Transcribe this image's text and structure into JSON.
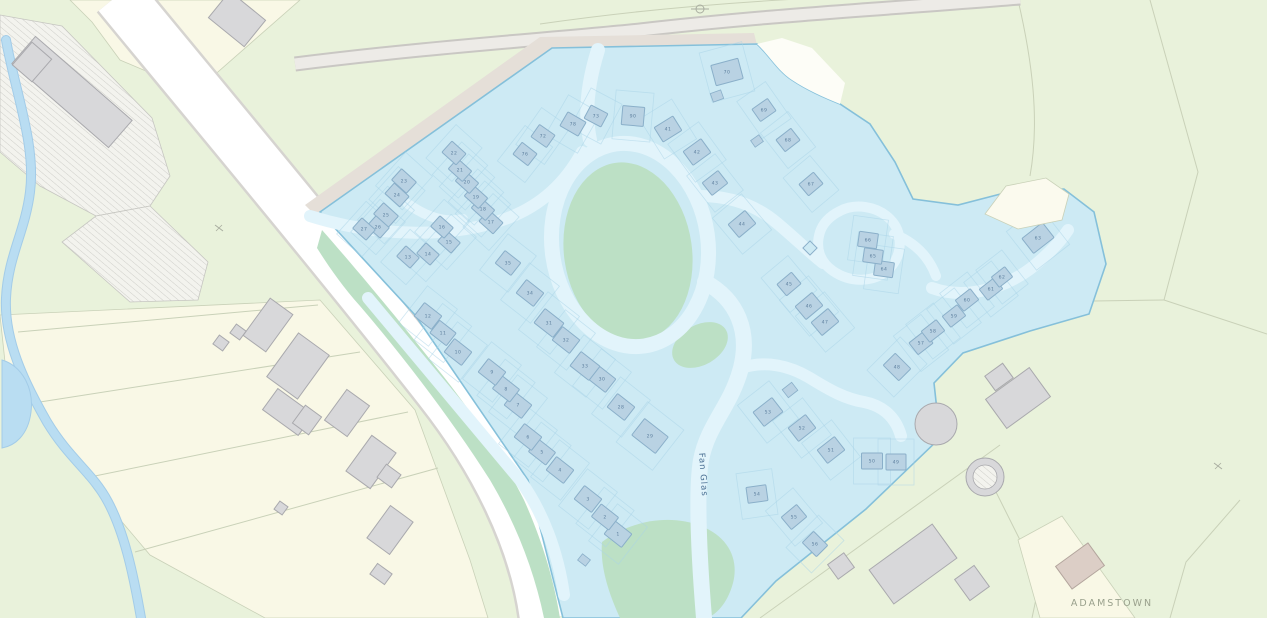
{
  "labels": {
    "street": "Fan Glas",
    "townland": "ADAMSTOWN",
    "street_x": 699,
    "street_y": 453,
    "street_rot": 86,
    "townland_x": 1112,
    "townland_y": 606
  },
  "colors": {
    "field_green": "#e9f2db",
    "cream_field": "#f9f8e6",
    "field_line": "#c9d1b8",
    "hatch_line": "#c6c6c1",
    "stream": "#b9ddf2",
    "stream_edge": "#a3cce8",
    "road_main": "#ffffff",
    "road_main_edge": "#d6d4d0",
    "road_top": "#edebe7",
    "road_top_edge": "#c9c7c3",
    "verge": "#e5dfd8",
    "estate_fill": "#cdeaf4",
    "estate_edge": "#85c0da",
    "estate_green": "#bce0c5",
    "road_inner": "#e2f4fb",
    "lot_line": "#a9d4e7",
    "bldg_fill": "#b9d2e3",
    "bldg_edge": "#8aafc9",
    "grey_fill": "#d8d8da",
    "grey_edge": "#a9a9ad",
    "tan_fill": "#dccec6",
    "tan_edge": "#b3a59d",
    "notch": "#fdfdf7",
    "tan_parcel": "#fbfaee",
    "num_color": "#5d7f9e",
    "street_label": "#4a6f93",
    "townland_label": "#9aa18d",
    "symbol_grey": "#a9ada0"
  },
  "terrain": {
    "cream_fields": [
      "M70,0 L300,0 L195,92 L120,60 L92,22 Z",
      "M0,315 L320,300 L415,410 L470,560 L488,618 L265,618 L150,555 L95,490 L40,412 L5,362 Z"
    ],
    "field_lines": [
      "M318,305 L18,332",
      "M360,352 L40,402",
      "M408,412 L85,478",
      "M438,468 L135,552",
      "M1150,0 L1198,172 L1164,300",
      "M1164,300 L1094,301",
      "M1164,300 L1267,334",
      "M1018,0 C1032,60 1040,120 1030,176",
      "M540,24 C650,8 760,0 860,-4",
      "M760,618 L1000,445",
      "M985,470 L1040,580 L1032,618",
      "M1240,500 L1186,562 L1170,618",
      "M195,92 L250,120"
    ],
    "hatch_areas": [
      "M0,15 L62,26 L152,118 L170,176 L150,206 L96,216 L40,186 L0,152 Z",
      "M96,216 L150,206 L208,262 L198,300 L130,302 L62,242 Z"
    ],
    "white_notch": "M757,44 C770,56 777,70 792,80 C807,90 823,97 840,104 L845,83 L812,48 L782,38 Z",
    "tan_parcel": "M985,214 L1006,186 L1046,178 L1069,194 L1062,220 L1018,229 Z",
    "cream_wedge": "M1018,540 L1062,516 L1135,618 L1040,618 Z"
  },
  "water": {
    "stream": "M6,40 C16,95 36,145 30,192 C25,232 8,256 6,298 C4,340 24,382 47,422 C70,460 92,472 108,502 C124,532 133,572 141,618",
    "pool": "M2,360 C22,366 34,388 31,412 C28,436 14,446 2,448 Z"
  },
  "roads": {
    "main": {
      "d": "M118,-5 C200,95 330,250 440,390 C495,460 535,540 545,618",
      "w": 50
    },
    "top": {
      "d": "M295,64 C430,47 540,40 640,30 C770,15 900,8 1020,-2",
      "w": 11
    },
    "verge": "M316,216 L552,49 L757,45 L754,33 L540,37 L305,205 Z"
  },
  "estate": {
    "outline": "M320,212 L552,48 L757,44 C770,56 777,70 792,80 C807,90 823,97 840,104 L870,124 L895,162 L913,199 L958,205 L1012,191 L1064,189 L1094,212 L1106,264 L1089,314 L1030,331 L963,353 L934,383 L940,438 L866,509 L776,581 L741,618 L563,618 L528,480 L415,315 Z",
    "greens": [
      {
        "e": [
          628,
          252,
          64,
          90,
          -8
        ]
      },
      {
        "e": [
          700,
          345,
          30,
          20,
          -30
        ]
      },
      {
        "d": "M322,230 C352,264 395,315 440,372 C478,420 505,462 524,500 C542,540 554,580 560,618 L544,618 C534,570 516,524 490,480 C455,425 408,362 360,306 C342,286 327,264 317,248 Z"
      },
      {
        "d": "M602,542 C632,520 670,514 701,526 C729,537 739,560 733,583 C727,605 715,615 707,618 L620,618 C608,592 600,566 602,542 Z"
      }
    ],
    "roads": [
      {
        "d": "M598,50 C588,82 584,112 590,140",
        "w": 14
      },
      {
        "e": [
          630,
          245,
          78,
          102,
          -8
        ],
        "w": 15
      },
      {
        "d": "M705,282 C738,300 750,332 741,368 C731,406 708,424 701,460 C696,490 699,556 704,618",
        "w": 16
      },
      {
        "d": "M310,216 C380,238 455,238 508,218 C545,204 568,178 582,152",
        "w": 12
      },
      {
        "d": "M408,204 C428,218 447,223 463,219",
        "w": 10
      },
      {
        "d": "M368,298 C420,360 470,420 520,480 C543,512 558,552 564,595",
        "w": 12
      },
      {
        "d": "M700,196 C732,196 757,206 777,223 C796,239 809,252 823,263",
        "w": 12
      },
      {
        "d": "M820,232 C815,248 820,262 833,271 C852,284 876,282 890,268 C903,254 903,232 890,219 C877,206 855,203 840,211 C830,216 823,223 820,232 Z",
        "w": 10
      },
      {
        "d": "M894,234 C916,243 929,257 936,276",
        "w": 10
      },
      {
        "d": "M932,288 C962,299 1000,291 1030,269 C1048,255 1060,242 1068,230",
        "w": 12
      },
      {
        "d": "M741,368 C766,360 790,366 810,378 C831,391 846,399 864,402 C884,406 896,418 901,436",
        "w": 12
      }
    ],
    "buildings": [
      {
        "n": "1",
        "x": 618,
        "y": 534,
        "w": 22,
        "h": 17,
        "a": 38
      },
      {
        "n": "2",
        "x": 605,
        "y": 517,
        "w": 22,
        "h": 16,
        "a": 38
      },
      {
        "n": "3",
        "x": 588,
        "y": 499,
        "w": 22,
        "h": 17,
        "a": 38
      },
      {
        "n": "4",
        "x": 560,
        "y": 470,
        "w": 22,
        "h": 17,
        "a": 38
      },
      {
        "n": "5",
        "x": 542,
        "y": 452,
        "w": 22,
        "h": 16,
        "a": 38
      },
      {
        "n": "6",
        "x": 528,
        "y": 437,
        "w": 22,
        "h": 17,
        "a": 38
      },
      {
        "n": "7",
        "x": 518,
        "y": 405,
        "w": 22,
        "h": 17,
        "a": 38
      },
      {
        "n": "8",
        "x": 506,
        "y": 389,
        "w": 22,
        "h": 16,
        "a": 38
      },
      {
        "n": "9",
        "x": 492,
        "y": 372,
        "w": 22,
        "h": 17,
        "a": 38
      },
      {
        "n": "10",
        "x": 458,
        "y": 352,
        "w": 22,
        "h": 17,
        "a": 38
      },
      {
        "n": "11",
        "x": 443,
        "y": 333,
        "w": 21,
        "h": 16,
        "a": 38
      },
      {
        "n": "12",
        "x": 428,
        "y": 316,
        "w": 22,
        "h": 17,
        "a": 38
      },
      {
        "n": "13",
        "x": 408,
        "y": 257,
        "w": 18,
        "h": 14,
        "a": 42
      },
      {
        "n": "14",
        "x": 428,
        "y": 254,
        "w": 18,
        "h": 14,
        "a": 42
      },
      {
        "n": "15",
        "x": 449,
        "y": 242,
        "w": 18,
        "h": 14,
        "a": 42
      },
      {
        "n": "16",
        "x": 442,
        "y": 227,
        "w": 18,
        "h": 14,
        "a": 42
      },
      {
        "n": "17",
        "x": 491,
        "y": 222,
        "w": 19,
        "h": 15,
        "a": 42
      },
      {
        "n": "18",
        "x": 483,
        "y": 209,
        "w": 19,
        "h": 14,
        "a": 42
      },
      {
        "n": "19",
        "x": 476,
        "y": 197,
        "w": 19,
        "h": 14,
        "a": 42
      },
      {
        "n": "20",
        "x": 467,
        "y": 182,
        "w": 19,
        "h": 14,
        "a": 42
      },
      {
        "n": "21",
        "x": 460,
        "y": 170,
        "w": 19,
        "h": 14,
        "a": 42
      },
      {
        "n": "22",
        "x": 454,
        "y": 153,
        "w": 19,
        "h": 15,
        "a": 42
      },
      {
        "n": "23",
        "x": 404,
        "y": 181,
        "w": 20,
        "h": 15,
        "a": 42
      },
      {
        "n": "24",
        "x": 397,
        "y": 195,
        "w": 20,
        "h": 14,
        "a": 42
      },
      {
        "n": "25",
        "x": 386,
        "y": 215,
        "w": 20,
        "h": 15,
        "a": 42
      },
      {
        "n": "26",
        "x": 378,
        "y": 227,
        "w": 18,
        "h": 14,
        "a": 42
      },
      {
        "n": "27",
        "x": 364,
        "y": 229,
        "w": 18,
        "h": 14,
        "a": 42
      },
      {
        "n": "28",
        "x": 621,
        "y": 407,
        "w": 22,
        "h": 17,
        "a": 38
      },
      {
        "n": "29",
        "x": 650,
        "y": 436,
        "w": 30,
        "h": 21,
        "a": 38
      },
      {
        "n": "30",
        "x": 602,
        "y": 379,
        "w": 22,
        "h": 17,
        "a": 38
      },
      {
        "n": "31",
        "x": 549,
        "y": 323,
        "w": 24,
        "h": 18,
        "a": 38
      },
      {
        "n": "32",
        "x": 566,
        "y": 340,
        "w": 22,
        "h": 17,
        "a": 38
      },
      {
        "n": "33",
        "x": 585,
        "y": 366,
        "w": 24,
        "h": 18,
        "a": 38
      },
      {
        "n": "34",
        "x": 530,
        "y": 293,
        "w": 22,
        "h": 17,
        "a": 38
      },
      {
        "n": "35",
        "x": 508,
        "y": 263,
        "w": 20,
        "h": 16,
        "a": 38
      },
      {
        "n": "41",
        "x": 668,
        "y": 129,
        "w": 22,
        "h": 17,
        "a": -32
      },
      {
        "n": "42",
        "x": 697,
        "y": 152,
        "w": 22,
        "h": 17,
        "a": -36
      },
      {
        "n": "43",
        "x": 715,
        "y": 183,
        "w": 20,
        "h": 16,
        "a": -38
      },
      {
        "n": "44",
        "x": 742,
        "y": 224,
        "w": 22,
        "h": 17,
        "a": -40
      },
      {
        "n": "45",
        "x": 789,
        "y": 284,
        "w": 19,
        "h": 15,
        "a": -40
      },
      {
        "n": "46",
        "x": 809,
        "y": 306,
        "w": 22,
        "h": 17,
        "a": -40
      },
      {
        "n": "47",
        "x": 825,
        "y": 322,
        "w": 22,
        "h": 17,
        "a": -40
      },
      {
        "n": "48",
        "x": 897,
        "y": 367,
        "w": 22,
        "h": 17,
        "a": 45
      },
      {
        "n": "49",
        "x": 896,
        "y": 462,
        "w": 20,
        "h": 16,
        "a": 0
      },
      {
        "n": "50",
        "x": 872,
        "y": 461,
        "w": 21,
        "h": 16,
        "a": 0
      },
      {
        "n": "51",
        "x": 831,
        "y": 450,
        "w": 22,
        "h": 17,
        "a": -38
      },
      {
        "n": "52",
        "x": 802,
        "y": 428,
        "w": 22,
        "h": 17,
        "a": -38
      },
      {
        "n": "53",
        "x": 768,
        "y": 412,
        "w": 24,
        "h": 18,
        "a": -38
      },
      {
        "n": "54",
        "x": 757,
        "y": 494,
        "w": 20,
        "h": 16,
        "a": -8
      },
      {
        "n": "55",
        "x": 794,
        "y": 517,
        "w": 20,
        "h": 16,
        "a": -40
      },
      {
        "n": "56",
        "x": 815,
        "y": 544,
        "w": 20,
        "h": 16,
        "a": 45
      },
      {
        "n": "57",
        "x": 921,
        "y": 343,
        "w": 19,
        "h": 15,
        "a": -38
      },
      {
        "n": "58",
        "x": 933,
        "y": 331,
        "w": 19,
        "h": 14,
        "a": -38
      },
      {
        "n": "59",
        "x": 954,
        "y": 316,
        "w": 19,
        "h": 14,
        "a": -38
      },
      {
        "n": "60",
        "x": 967,
        "y": 300,
        "w": 19,
        "h": 14,
        "a": -38
      },
      {
        "n": "61",
        "x": 991,
        "y": 289,
        "w": 19,
        "h": 14,
        "a": -38
      },
      {
        "n": "62",
        "x": 1002,
        "y": 277,
        "w": 17,
        "h": 13,
        "a": -38
      },
      {
        "n": "63",
        "x": 1038,
        "y": 238,
        "w": 26,
        "h": 19,
        "a": -38
      },
      {
        "n": "64",
        "x": 884,
        "y": 269,
        "w": 19,
        "h": 15,
        "a": 8
      },
      {
        "n": "65",
        "x": 873,
        "y": 256,
        "w": 19,
        "h": 14,
        "a": 8
      },
      {
        "n": "66",
        "x": 868,
        "y": 240,
        "w": 19,
        "h": 15,
        "a": 8
      },
      {
        "n": "67",
        "x": 811,
        "y": 184,
        "w": 19,
        "h": 15,
        "a": -40
      },
      {
        "n": "68",
        "x": 788,
        "y": 140,
        "w": 19,
        "h": 15,
        "a": -38
      },
      {
        "n": "69",
        "x": 764,
        "y": 110,
        "w": 19,
        "h": 15,
        "a": -35
      },
      {
        "n": "70",
        "x": 727,
        "y": 72,
        "w": 28,
        "h": 21,
        "a": -15
      },
      {
        "n": "72",
        "x": 543,
        "y": 136,
        "w": 19,
        "h": 15,
        "a": 35
      },
      {
        "n": "73",
        "x": 596,
        "y": 116,
        "w": 19,
        "h": 15,
        "a": 28
      },
      {
        "n": "76",
        "x": 525,
        "y": 154,
        "w": 19,
        "h": 15,
        "a": 38
      },
      {
        "n": "78",
        "x": 573,
        "y": 124,
        "w": 21,
        "h": 16,
        "a": 30
      },
      {
        "n": "90",
        "x": 633,
        "y": 116,
        "w": 22,
        "h": 19,
        "a": 5
      }
    ],
    "garages": [
      {
        "x": 717,
        "y": 96,
        "w": 11,
        "h": 9,
        "a": -20
      },
      {
        "x": 757,
        "y": 141,
        "w": 10,
        "h": 8,
        "a": -35
      },
      {
        "x": 790,
        "y": 390,
        "w": 12,
        "h": 10,
        "a": -38
      },
      {
        "x": 584,
        "y": 560,
        "w": 10,
        "h": 8,
        "a": 38
      }
    ]
  },
  "outside": {
    "buildings": [
      {
        "x": 72,
        "y": 92,
        "w": 128,
        "h": 36,
        "a": 41
      },
      {
        "x": 32,
        "y": 62,
        "w": 26,
        "h": 30,
        "a": 41
      },
      {
        "x": 237,
        "y": 19,
        "w": 46,
        "h": 34,
        "a": 39
      },
      {
        "x": 268,
        "y": 325,
        "w": 28,
        "h": 46,
        "a": 36
      },
      {
        "x": 298,
        "y": 366,
        "w": 38,
        "h": 54,
        "a": 36
      },
      {
        "x": 288,
        "y": 412,
        "w": 44,
        "h": 26,
        "a": 36
      },
      {
        "x": 307,
        "y": 420,
        "w": 20,
        "h": 22,
        "a": 36
      },
      {
        "x": 347,
        "y": 413,
        "w": 28,
        "h": 38,
        "a": 36
      },
      {
        "x": 371,
        "y": 462,
        "w": 30,
        "h": 44,
        "a": 36
      },
      {
        "x": 389,
        "y": 476,
        "w": 18,
        "h": 16,
        "a": 36
      },
      {
        "x": 390,
        "y": 530,
        "w": 28,
        "h": 40,
        "a": 36
      },
      {
        "x": 381,
        "y": 574,
        "w": 18,
        "h": 13,
        "a": 36
      },
      {
        "x": 221,
        "y": 343,
        "w": 12,
        "h": 11,
        "a": 36
      },
      {
        "x": 238,
        "y": 332,
        "w": 12,
        "h": 11,
        "a": 36
      },
      {
        "x": 281,
        "y": 508,
        "w": 10,
        "h": 10,
        "a": 36
      },
      {
        "x": 913,
        "y": 564,
        "w": 78,
        "h": 42,
        "a": -36
      },
      {
        "x": 972,
        "y": 583,
        "w": 26,
        "h": 24,
        "a": 54
      },
      {
        "x": 1018,
        "y": 398,
        "w": 54,
        "h": 36,
        "a": -36
      },
      {
        "x": 999,
        "y": 377,
        "w": 22,
        "h": 18,
        "a": -36
      },
      {
        "x": 841,
        "y": 566,
        "w": 20,
        "h": 18,
        "a": -36
      },
      {
        "x": 1080,
        "y": 566,
        "w": 40,
        "h": 28,
        "a": -36,
        "t": "tan"
      }
    ],
    "circles": [
      {
        "x": 936,
        "y": 424,
        "r": 21
      },
      {
        "x": 985,
        "y": 477,
        "r": 19,
        "inner": 12
      }
    ]
  },
  "symbols": {
    "survey_circle": {
      "x": 700,
      "y": 9,
      "r": 4
    },
    "marker_diamond": {
      "x": 810,
      "y": 248,
      "s": 5
    },
    "gate_marks": [
      {
        "x": 219,
        "y": 228
      },
      {
        "x": 1218,
        "y": 466
      }
    ]
  }
}
